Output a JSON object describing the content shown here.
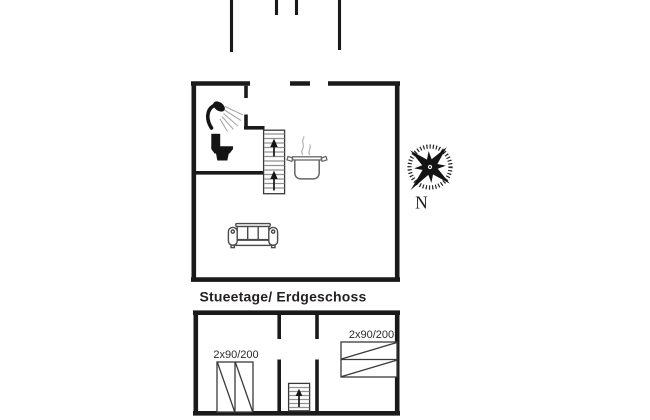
{
  "floor_plans": {
    "ground_floor": {
      "label": "Stueetage/ Erdgeschoss",
      "features": [
        "shower-icon",
        "toilet-icon",
        "staircase-up",
        "cooking-pot-icon",
        "sofa-icon"
      ]
    },
    "lower_floor": {
      "bed_left_label": "2x90/200",
      "bed_right_label": "2x90/200",
      "features": [
        "double-bed-icon",
        "double-bed-icon",
        "staircase-up"
      ]
    }
  },
  "compass": {
    "north_label": "N"
  },
  "icons": {
    "shower": "shower-icon",
    "toilet": "toilet-icon",
    "cooking_pot": "cooking-pot-icon",
    "sofa": "sofa-icon",
    "stairs_arrow": "up-arrow-icon",
    "compass_rose": "compass-rose-icon"
  },
  "colors": {
    "background": "#ffffff",
    "wall": "#1a1a1a",
    "stair_tread": "#909090",
    "icon_dark": "#141414",
    "icon_gray": "#666666",
    "steam_gray": "#bbbbbb",
    "text": "#231f20"
  }
}
